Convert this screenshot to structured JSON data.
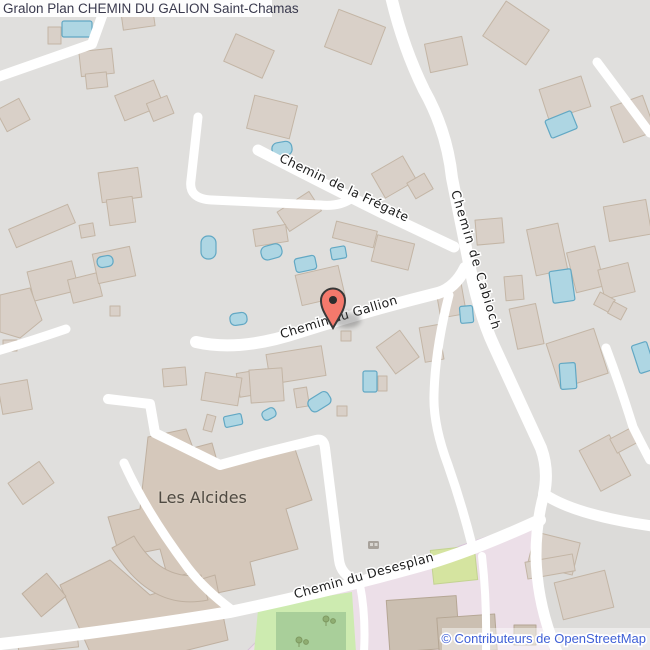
{
  "header": {
    "title": "Gralon Plan CHEMIN DU GALION Saint-Chamas"
  },
  "streets": {
    "fregate": "Chemin de la Frégate",
    "cabioch": "Chemin de Cabioch",
    "gallion": "Chemin du Gallion",
    "desesplan": "Chemin du Desesplan"
  },
  "places": {
    "les_alcides": "Les Alcides"
  },
  "attribution": {
    "text": "© Contributeurs de OpenStreetMap",
    "color": "#3e5fd6"
  },
  "marker": {
    "name": "location-pin",
    "fill": "#f4796c",
    "outline": "#383838"
  },
  "icons": [
    "location-pin-icon",
    "tree-icon",
    "picnic-site-icon"
  ],
  "colors": {
    "background": "#e0dfdd",
    "building": "#d9d0c8",
    "building_outline": "#c3b5a5",
    "large_building": "#d5c8bb",
    "road": "#ffffff",
    "pool": "#aed6e3",
    "pool_outline": "#62a8c4",
    "park_light": "#cdebb0",
    "park_dark": "#a9cf9a",
    "pitch": "#d5e4a0",
    "school_area": "#ecdfe8",
    "street_label": "#1c1c1c",
    "title": "#3a3a4e"
  }
}
